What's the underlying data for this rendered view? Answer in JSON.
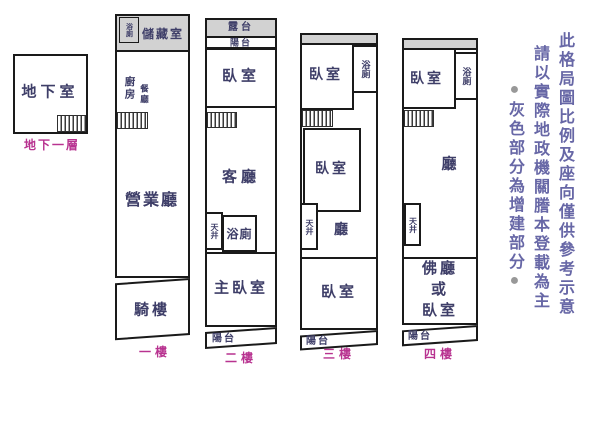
{
  "colors": {
    "outline": "#1a1a1a",
    "extension_gray": "#d2d2d2",
    "room_text": "#3e3e68",
    "floor_label_text": "#b83390",
    "disclaimer_text": "#6767a6",
    "bullet_gray": "#989898"
  },
  "basement": {
    "room": "地下室",
    "floor_label": "地下一層"
  },
  "floor1": {
    "bath": "浴廁",
    "storage": "儲藏室",
    "kitchen": "廚房",
    "dining": "餐廳",
    "business_hall": "營業廳",
    "arcade": "騎樓",
    "floor_label": "一樓"
  },
  "floor2": {
    "roof_terrace": "露台",
    "balcony_top": "陽台",
    "bedroom": "臥室",
    "living_room": "客廳",
    "light_well": "天井",
    "bath": "浴廁",
    "master_bedroom": "主臥室",
    "balcony_bottom": "陽台",
    "floor_label": "二樓"
  },
  "floor3": {
    "bedroom_top": "臥室",
    "bath": "浴廁",
    "bedroom_middle": "臥室",
    "light_well": "天井",
    "hall": "廳",
    "bedroom_bottom": "臥室",
    "balcony": "陽台",
    "floor_label": "三樓"
  },
  "floor4": {
    "bedroom": "臥室",
    "bath": "浴廁",
    "hall": "廳",
    "light_well": "天井",
    "buddha_hall_line1": "佛廳",
    "buddha_hall_line2": "或",
    "buddha_hall_line3": "臥室",
    "balcony": "陽台",
    "floor_label": "四樓"
  },
  "disclaimer": {
    "column1": "此格局圖比例及座向僅供參考示意",
    "column2": "請以實際地政機關謄本登載為主",
    "column3": "灰色部分為增建部分",
    "bullet": "●"
  }
}
